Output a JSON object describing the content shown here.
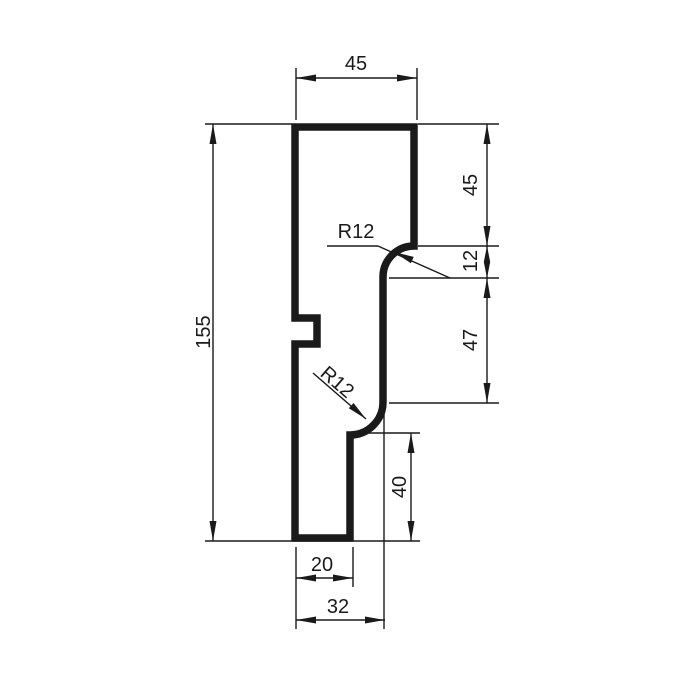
{
  "drawing": {
    "background": "#ffffff",
    "line_color": "#1a1a1a",
    "dimensions": {
      "top_width": "45",
      "height_total": "155",
      "right_upper": "45",
      "right_step": "12",
      "right_middle": "47",
      "right_lower": "40",
      "bottom_inner": "20",
      "bottom_outer": "32",
      "radius_upper": "R12",
      "radius_lower": "R12"
    }
  }
}
